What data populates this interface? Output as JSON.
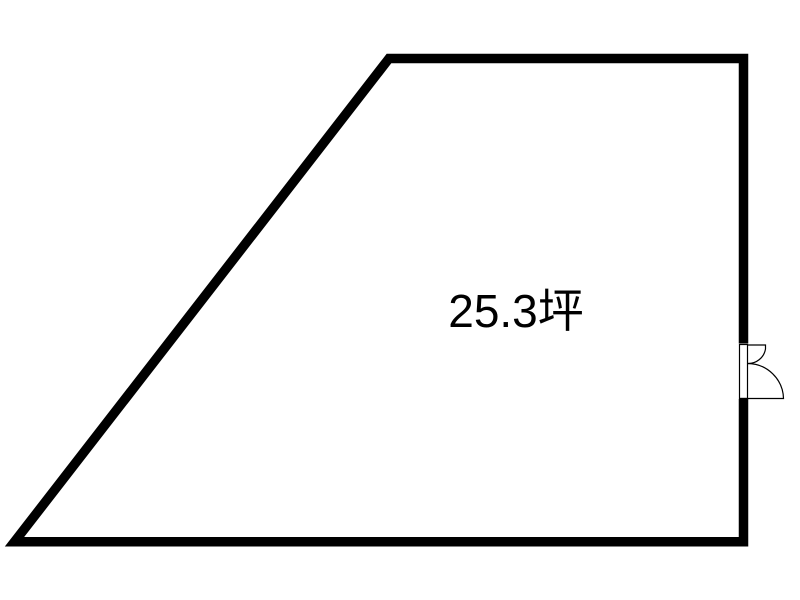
{
  "page": {
    "background_color": "#ffffff",
    "width": 800,
    "height": 600
  },
  "floorplan": {
    "area_label": "25.3坪",
    "colors": {
      "wall": "#000000",
      "line": "#000000",
      "text": "#000000",
      "floor": "#ffffff"
    },
    "wall_stroke_width": 9.5,
    "thin_stroke_width": 1.2,
    "outline_points": "389,58.5 743.5,58.5 743.5,541.75 14.5,541.75",
    "door": {
      "gap": {
        "x": 736,
        "y": 343.5,
        "width": 15,
        "height": 55.5
      },
      "jamb": {
        "x": 739.5,
        "y": 344.5,
        "width": 8,
        "height": 54
      },
      "small_leaf_path": "M747.5 345 H765.5 V349 A17.5 17.5 0 0 1 747.5 363.5",
      "large_leaf_path": "M747.5 363.5 A36 36 0 0 1 783.5 398.5 H739.5"
    },
    "label_pos": {
      "x": 516,
      "y": 327
    }
  }
}
